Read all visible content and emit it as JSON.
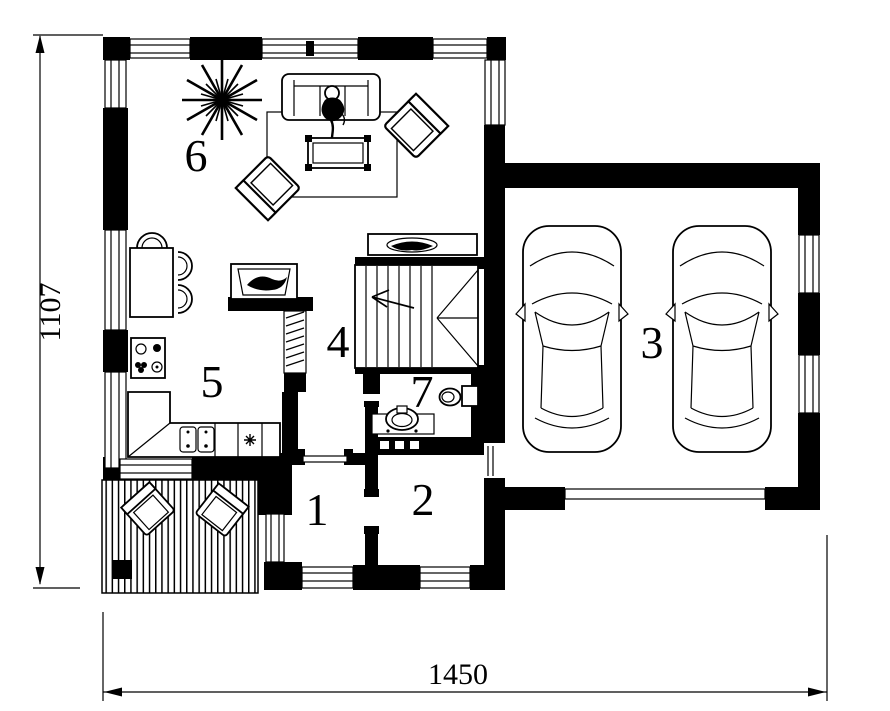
{
  "drawing": {
    "type": "architectural-floor-plan",
    "background_color": "#ffffff",
    "ink_color": "#000000",
    "dimensions": {
      "height_label": "1107",
      "width_label": "1450"
    },
    "rooms": {
      "room1": "1",
      "room2": "2",
      "room3": "3",
      "room4": "4",
      "room5": "5",
      "room6": "6",
      "room7": "7"
    },
    "icons": [
      "car-icon",
      "sofa-icon",
      "person-icon",
      "coffee-table-icon",
      "armchair-icon",
      "rug-icon",
      "plant-icon",
      "dining-table-icon",
      "dining-chair-icon",
      "tv-cabinet-icon",
      "tv-icon",
      "stairs-icon",
      "stair-direction-arrow-icon",
      "console-table-icon",
      "bowl-icon",
      "kitchen-counter-icon",
      "double-sink-icon",
      "stove-icon",
      "toilet-icon",
      "washbasin-icon",
      "deck-icon",
      "lounge-chair-icon",
      "column-icon",
      "window-icon",
      "door-icon",
      "garage-door-icon"
    ]
  }
}
